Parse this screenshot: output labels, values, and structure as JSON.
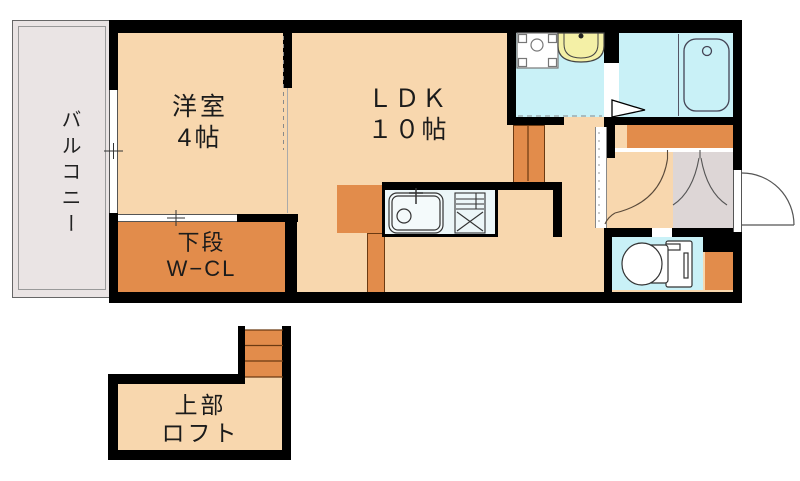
{
  "plan_title": "1LDK apartment floor plan",
  "rooms": {
    "balcony": {
      "label": "バルコニー"
    },
    "western_room": {
      "label": "洋室",
      "size": "4帖"
    },
    "ldk": {
      "label": "ＬＤＫ",
      "size": "１０帖"
    },
    "closet": {
      "label": "下段",
      "sublabel": "W−CL"
    },
    "loft": {
      "label": "上部",
      "sublabel": "ロフト"
    }
  },
  "icons": {
    "washing_machine": "washing-machine-pan-icon",
    "washbasin": "washbasin-icon",
    "bathtub": "bathtub-icon",
    "toilet": "toilet-icon",
    "kitchen_sink": "kitchen-sink-icon",
    "stove": "stove-icon",
    "entrance_door": "door-swing-icon",
    "interior_doors": "door-arc-icon",
    "loft_stairs": "stairs-icon",
    "loft_ladder": "ladder-icon",
    "window": "window-icon"
  },
  "colors": {
    "wall": "#000000",
    "floor_peach": "#F8D7AE",
    "accent_orange": "#E28C4B",
    "water_cyan": "#C9F1F7",
    "basin_yellow": "#F4F0A6",
    "balcony_gray": "#EAE4E4",
    "entry_gray": "#DDD6D6",
    "counter_white": "#ECF6F8"
  }
}
